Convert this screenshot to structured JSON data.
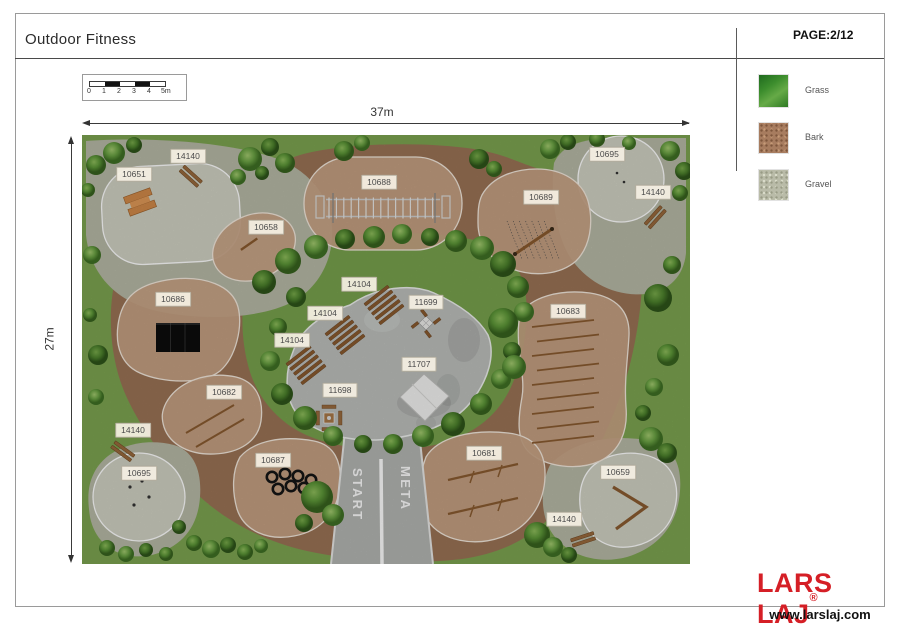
{
  "window": {
    "title": "Outdoor Fitness",
    "page_label": "PAGE:2/12"
  },
  "legend": {
    "items": [
      {
        "label": "Grass",
        "color": "#3c8d2d"
      },
      {
        "label": "Bark",
        "color": "#a77c5f"
      },
      {
        "label": "Gravel",
        "color": "#b9bba8"
      }
    ]
  },
  "scale_bar": {
    "ticks": [
      "0",
      "1",
      "2",
      "3",
      "4"
    ],
    "end_label": "5m"
  },
  "plan": {
    "width_label": "37m",
    "height_label": "27m",
    "start_label": "START",
    "meta_label": "META",
    "labels": [
      {
        "text": "14140",
        "x": 106,
        "y": 21
      },
      {
        "text": "10651",
        "x": 52,
        "y": 39
      },
      {
        "text": "10688",
        "x": 297,
        "y": 47
      },
      {
        "text": "10695",
        "x": 525,
        "y": 19
      },
      {
        "text": "14140",
        "x": 571,
        "y": 57
      },
      {
        "text": "10689",
        "x": 459,
        "y": 62
      },
      {
        "text": "10658",
        "x": 184,
        "y": 92
      },
      {
        "text": "10686",
        "x": 91,
        "y": 164
      },
      {
        "text": "14104",
        "x": 277,
        "y": 149
      },
      {
        "text": "11699",
        "x": 344,
        "y": 167
      },
      {
        "text": "14104",
        "x": 243,
        "y": 178
      },
      {
        "text": "10683",
        "x": 486,
        "y": 176
      },
      {
        "text": "14104",
        "x": 210,
        "y": 205
      },
      {
        "text": "11707",
        "x": 337,
        "y": 229
      },
      {
        "text": "11698",
        "x": 258,
        "y": 255
      },
      {
        "text": "10682",
        "x": 142,
        "y": 257
      },
      {
        "text": "14140",
        "x": 51,
        "y": 295
      },
      {
        "text": "10695",
        "x": 57,
        "y": 338
      },
      {
        "text": "10687",
        "x": 191,
        "y": 325
      },
      {
        "text": "10681",
        "x": 402,
        "y": 318
      },
      {
        "text": "10659",
        "x": 536,
        "y": 337
      },
      {
        "text": "14140",
        "x": 482,
        "y": 384
      }
    ]
  },
  "footer": {
    "brand": "LARS LAJ",
    "registered": "®",
    "website": "www.larslaj.com"
  },
  "colors": {
    "grass": "#7da551",
    "bark": "#9b7356",
    "bark_zone": "#c9a485",
    "gravel": "#b8baa7",
    "gravel_zone": "#d4d5c7",
    "concrete": "#bec0bd",
    "path": "#b4b6b3",
    "brand_red": "#d51f26"
  }
}
